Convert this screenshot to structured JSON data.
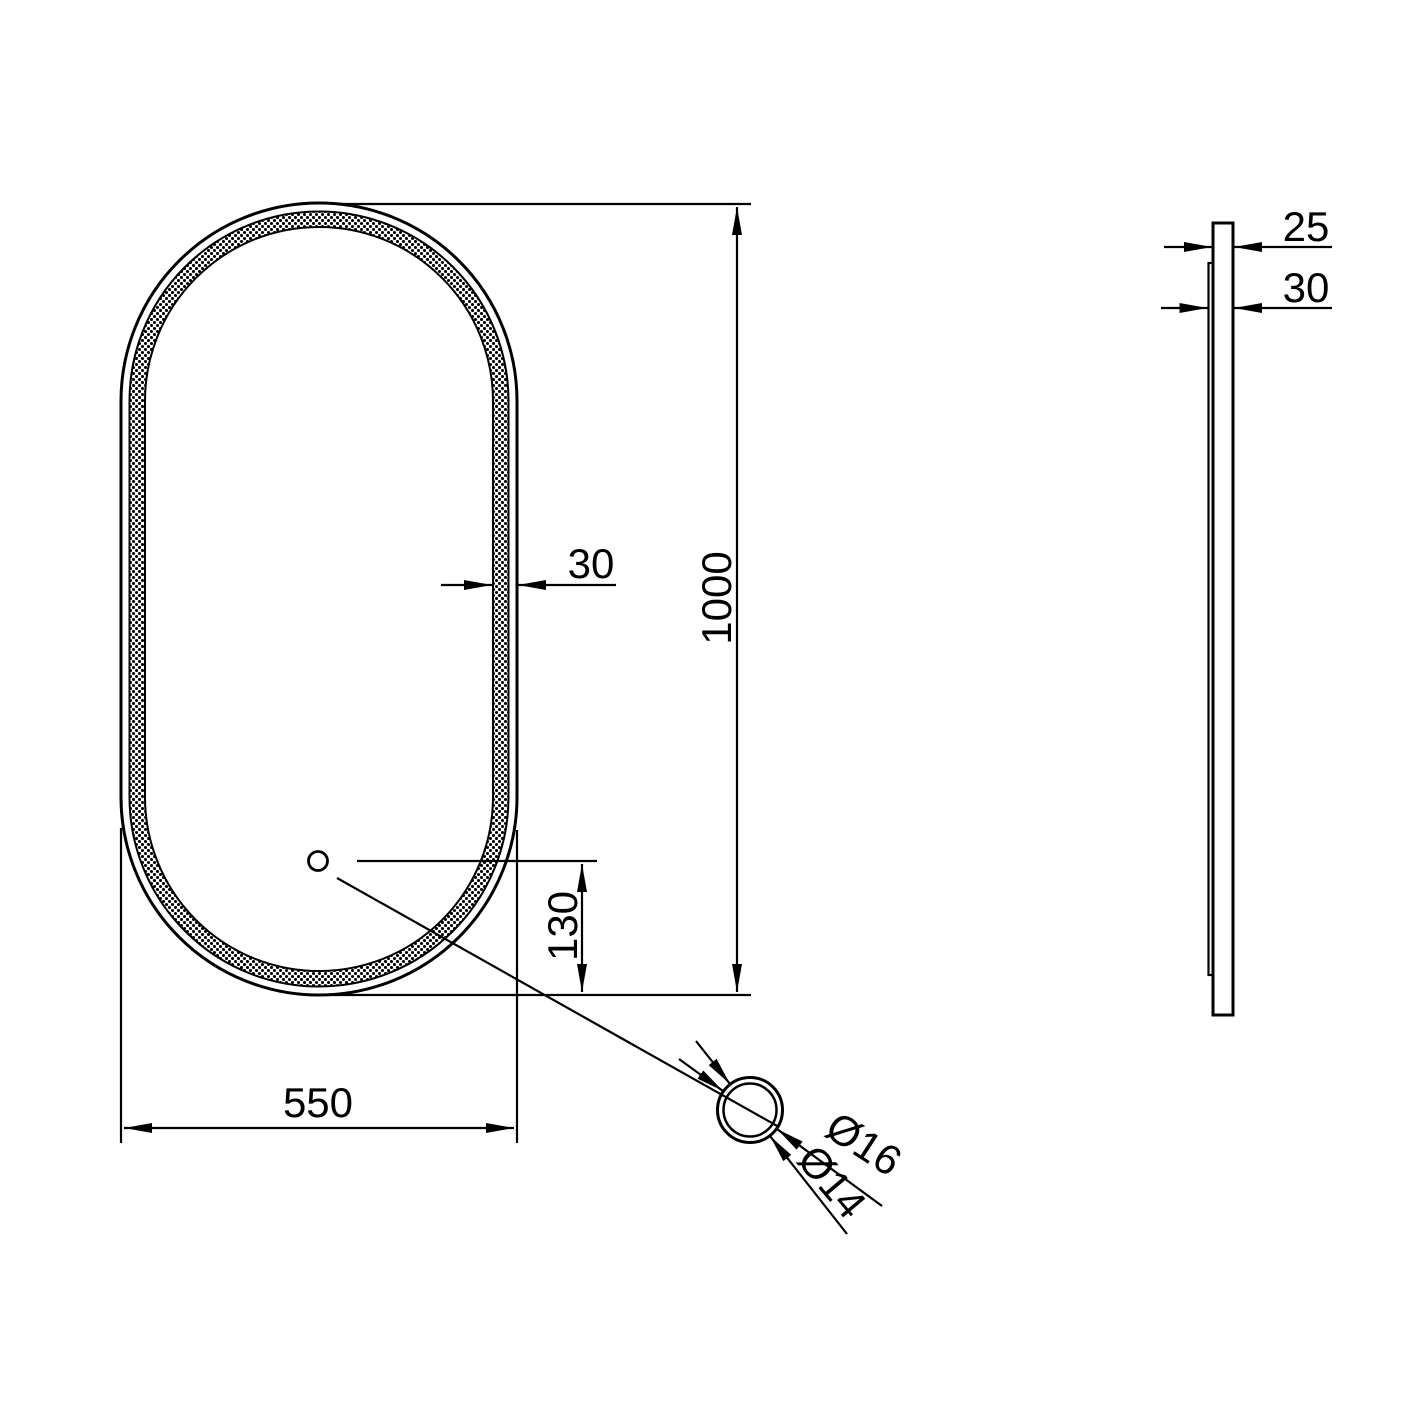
{
  "front_view": {
    "width_label": "550",
    "height_label": "1000",
    "band_width_label": "30",
    "sensor_offset_label": "130"
  },
  "side_view": {
    "glass_thickness_label": "25",
    "total_depth_label": "30"
  },
  "detail_view": {
    "outer_diameter_label": "Ø16",
    "inner_diameter_label": "Ø14"
  },
  "colors": {
    "line": "#000000",
    "background": "#ffffff"
  }
}
